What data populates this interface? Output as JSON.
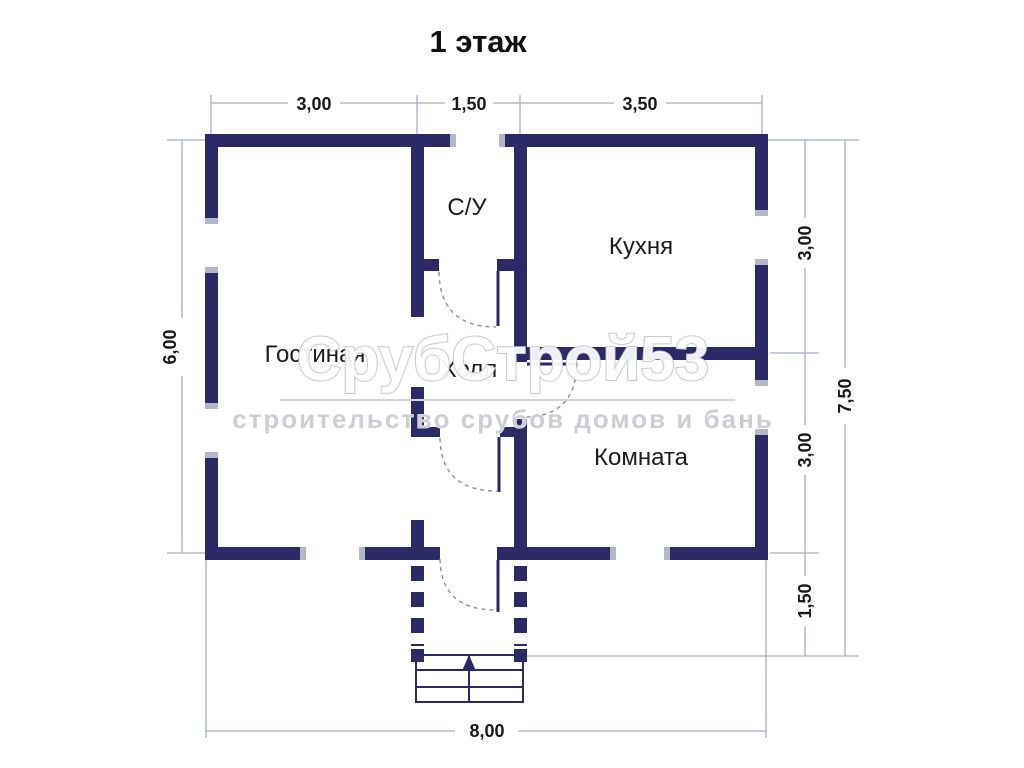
{
  "title": "1 этаж",
  "rooms": {
    "living": "Гостиная",
    "bathroom": "С/У",
    "kitchen": "Кухня",
    "hall": "Холл",
    "bedroom": "Комната"
  },
  "dimensions": {
    "top": [
      "3,00",
      "1,50",
      "3,50"
    ],
    "left": "6,00",
    "right_inner": [
      "3,00",
      "3,00",
      "1,50"
    ],
    "right_total": "7,50",
    "bottom": "8,00"
  },
  "watermark": {
    "brand": "СрубСтрой53",
    "tagline": "строительство срубов домов и бань"
  },
  "colors": {
    "wall": "#2b2a66",
    "dimension_line": "#a3adc9",
    "text": "#1a1a1c",
    "watermark_gray": "#c9c9d2"
  }
}
